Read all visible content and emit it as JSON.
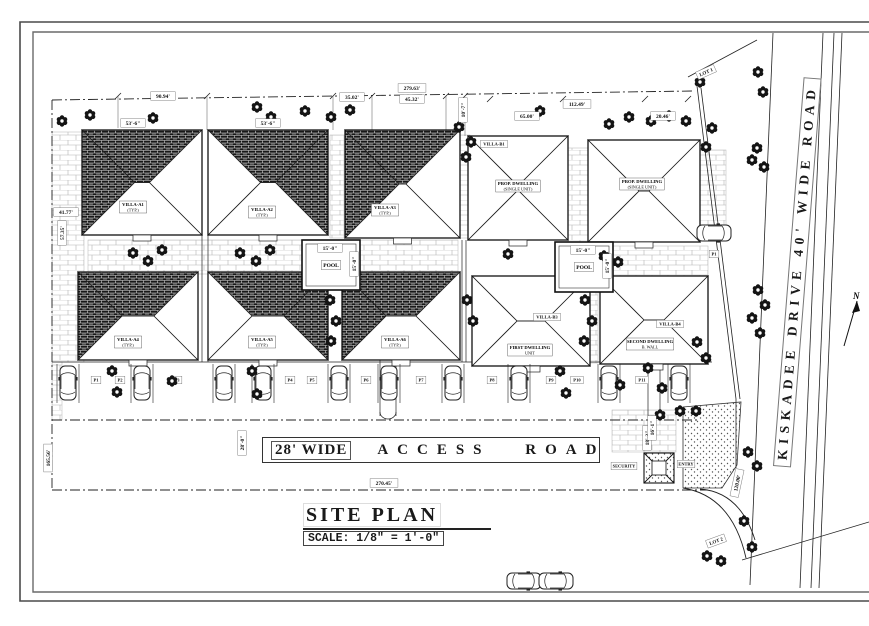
{
  "title_block": {
    "title": "SITE PLAN",
    "scale": "SCALE: 1/8\" = 1'-0\""
  },
  "roads": {
    "access_prefix": "28' WIDE",
    "access_name": "ACCESS ROAD",
    "main": "KISKADEE DRIVE 40' WIDE ROAD"
  },
  "north": {
    "label": "N",
    "x": 851,
    "y": 299
  },
  "lots": [
    {
      "text": "LOT 1",
      "x": 706,
      "y": 72,
      "rot": -24
    },
    {
      "text": "LOT 2",
      "x": 716,
      "y": 541,
      "rot": -20
    }
  ],
  "entrance": {
    "security_label": "SECURITY",
    "gate_label": "ENTRY",
    "booth": [
      644,
      453,
      30,
      30
    ],
    "security_pos": [
      624,
      466
    ],
    "gate_pos": [
      686,
      464
    ]
  },
  "pools": [
    {
      "label": "POOL",
      "dim": "15'-0\"",
      "x": 302,
      "y": 240,
      "w": 58,
      "h": 50
    },
    {
      "label": "POOL",
      "dim": "15'-0\"",
      "x": 555,
      "y": 242,
      "w": 58,
      "h": 50
    }
  ],
  "buildings": [
    {
      "id": "villa-a1",
      "label": "VILLA-A1",
      "sub": "(TYP.)",
      "x": 82,
      "y": 130,
      "w": 120,
      "h": 105,
      "hatch": true,
      "mirror": false,
      "lx": 133,
      "ly": 207
    },
    {
      "id": "villa-a2",
      "label": "VILLA-A2",
      "sub": "(TYP.)",
      "x": 208,
      "y": 130,
      "w": 120,
      "h": 105,
      "hatch": true,
      "mirror": true,
      "lx": 262,
      "ly": 212
    },
    {
      "id": "villa-a3",
      "label": "VILLA-A3",
      "sub": "(TYP.)",
      "x": 345,
      "y": 130,
      "w": 115,
      "h": 108,
      "hatch": true,
      "mirror": false,
      "lx": 385,
      "ly": 210
    },
    {
      "id": "villa-b1",
      "label": "PROP. DWELLING",
      "sub": "(SINGLE UNIT)",
      "tag": "VILLA-B1",
      "tx": 494,
      "ty": 144,
      "x": 468,
      "y": 136,
      "w": 100,
      "h": 104,
      "hatch": false,
      "lx": 518,
      "ly": 186
    },
    {
      "id": "villa-b2",
      "label": "PROP. DWELLING",
      "sub": "(SINGLE UNIT)",
      "x": 588,
      "y": 140,
      "w": 112,
      "h": 102,
      "hatch": false,
      "lx": 642,
      "ly": 184
    },
    {
      "id": "villa-a4",
      "label": "VILLA-A4",
      "sub": "(TYP.)",
      "x": 78,
      "y": 272,
      "w": 120,
      "h": 88,
      "hatch": true,
      "mirror": false,
      "lx": 128,
      "ly": 342
    },
    {
      "id": "villa-a5",
      "label": "VILLA-A5",
      "sub": "(TYP.)",
      "x": 208,
      "y": 272,
      "w": 120,
      "h": 88,
      "hatch": true,
      "mirror": true,
      "lx": 262,
      "ly": 342
    },
    {
      "id": "villa-a6",
      "label": "VILLA-A6",
      "sub": "(TYP.)",
      "x": 342,
      "y": 272,
      "w": 118,
      "h": 88,
      "hatch": true,
      "mirror": false,
      "lx": 395,
      "ly": 342
    },
    {
      "id": "villa-b3",
      "label": "FIRST DWELLING",
      "sub": "UNIT",
      "tag": "VILLA-B3",
      "tx": 547,
      "ty": 317,
      "x": 472,
      "y": 276,
      "w": 118,
      "h": 90,
      "hatch": false,
      "lx": 530,
      "ly": 350
    },
    {
      "id": "villa-b4",
      "label": "SECOND DWELLING",
      "sub": "B. WALL",
      "tag": "VILLA-B4",
      "tx": 670,
      "ty": 324,
      "x": 600,
      "y": 276,
      "w": 108,
      "h": 88,
      "hatch": false,
      "lx": 650,
      "ly": 344
    }
  ],
  "dimensions": [
    {
      "text": "90.94'",
      "x": 163,
      "y": 96,
      "rot": 0
    },
    {
      "text": "35.02'",
      "x": 352,
      "y": 97,
      "rot": 0
    },
    {
      "text": "279.63'",
      "x": 412,
      "y": 88,
      "rot": 0
    },
    {
      "text": "45.32'",
      "x": 412,
      "y": 99,
      "rot": 0
    },
    {
      "text": "65.00'",
      "x": 527,
      "y": 116,
      "rot": 0
    },
    {
      "text": "112.49'",
      "x": 577,
      "y": 104,
      "rot": 0
    },
    {
      "text": "20.46'",
      "x": 663,
      "y": 116,
      "rot": 0
    },
    {
      "text": "10'-7\"",
      "x": 463,
      "y": 110,
      "rot": -90
    },
    {
      "text": "41.77'",
      "x": 66,
      "y": 212,
      "rot": 0
    },
    {
      "text": "57.35'",
      "x": 62,
      "y": 233,
      "rot": -90
    },
    {
      "text": "165.56'",
      "x": 48,
      "y": 458,
      "rot": -90
    },
    {
      "text": "28'-0\"",
      "x": 242,
      "y": 443,
      "rot": -90
    },
    {
      "text": "18'-3\"",
      "x": 647,
      "y": 438,
      "rot": -90
    },
    {
      "text": "16'-1\"",
      "x": 652,
      "y": 428,
      "rot": -90
    },
    {
      "text": "270.45'",
      "x": 384,
      "y": 483,
      "rot": 0
    },
    {
      "text": "120.00'",
      "x": 737,
      "y": 483,
      "rot": -78
    },
    {
      "text": "15'-0\"",
      "x": 330,
      "y": 248,
      "rot": 0
    },
    {
      "text": "15'-0\"",
      "x": 583,
      "y": 250,
      "rot": 0
    },
    {
      "text": "15'-0\"",
      "x": 354,
      "y": 264,
      "rot": -90
    },
    {
      "text": "15'-0\"",
      "x": 607,
      "y": 266,
      "rot": -90
    },
    {
      "text": "53'-6\"",
      "x": 133,
      "y": 123,
      "rot": 0
    },
    {
      "text": "53'-6\"",
      "x": 268,
      "y": 123,
      "rot": 0
    }
  ],
  "parking": {
    "car_y": 383,
    "car_xs": [
      68,
      142,
      224,
      263,
      339,
      389,
      453,
      519,
      609,
      679
    ],
    "bay_labels": [
      "P1",
      "P2",
      "P3",
      "P4",
      "P5",
      "P6",
      "P7",
      "P8",
      "P9",
      "P10",
      "P11"
    ],
    "bay_label_pos": [
      [
        96,
        380
      ],
      [
        120,
        380
      ],
      [
        177,
        380
      ],
      [
        290,
        380
      ],
      [
        312,
        380
      ],
      [
        366,
        380
      ],
      [
        421,
        380
      ],
      [
        492,
        380
      ],
      [
        551,
        380
      ],
      [
        577,
        380
      ],
      [
        642,
        380
      ]
    ]
  },
  "extra_cars": [
    {
      "x": 714,
      "y": 233,
      "r": 90,
      "tag": "P1",
      "tagx": 714,
      "tagy": 254
    },
    {
      "x": 524,
      "y": 581,
      "r": 90
    },
    {
      "x": 556,
      "y": 581,
      "r": 90
    }
  ],
  "trees": [
    [
      62,
      121
    ],
    [
      90,
      115
    ],
    [
      153,
      118
    ],
    [
      257,
      107
    ],
    [
      271,
      117
    ],
    [
      305,
      111
    ],
    [
      331,
      117
    ],
    [
      350,
      110
    ],
    [
      459,
      127
    ],
    [
      471,
      142
    ],
    [
      466,
      157
    ],
    [
      540,
      111
    ],
    [
      609,
      124
    ],
    [
      629,
      117
    ],
    [
      651,
      121
    ],
    [
      669,
      116
    ],
    [
      686,
      121
    ],
    [
      700,
      82
    ],
    [
      712,
      128
    ],
    [
      706,
      147
    ],
    [
      758,
      72
    ],
    [
      763,
      92
    ],
    [
      757,
      148
    ],
    [
      764,
      167
    ],
    [
      752,
      160
    ],
    [
      758,
      290
    ],
    [
      765,
      305
    ],
    [
      752,
      318
    ],
    [
      760,
      333
    ],
    [
      748,
      452
    ],
    [
      757,
      466
    ],
    [
      744,
      521
    ],
    [
      752,
      547
    ],
    [
      707,
      556
    ],
    [
      721,
      561
    ],
    [
      133,
      253
    ],
    [
      148,
      261
    ],
    [
      162,
      250
    ],
    [
      240,
      253
    ],
    [
      256,
      261
    ],
    [
      270,
      250
    ],
    [
      330,
      300
    ],
    [
      336,
      321
    ],
    [
      331,
      341
    ],
    [
      467,
      300
    ],
    [
      473,
      321
    ],
    [
      585,
      300
    ],
    [
      592,
      321
    ],
    [
      584,
      341
    ],
    [
      604,
      256
    ],
    [
      618,
      262
    ],
    [
      508,
      254
    ],
    [
      112,
      371
    ],
    [
      117,
      392
    ],
    [
      172,
      381
    ],
    [
      252,
      371
    ],
    [
      257,
      394
    ],
    [
      560,
      371
    ],
    [
      566,
      393
    ],
    [
      620,
      385
    ],
    [
      697,
      342
    ],
    [
      706,
      358
    ],
    [
      648,
      368
    ],
    [
      662,
      388
    ],
    [
      680,
      411
    ],
    [
      660,
      415
    ],
    [
      696,
      411
    ]
  ],
  "paver_zones": [
    [
      52,
      132,
      32,
      230
    ],
    [
      88,
      240,
      370,
      34
    ],
    [
      330,
      135,
      14,
      103
    ],
    [
      460,
      135,
      10,
      103
    ],
    [
      568,
      148,
      30,
      215
    ],
    [
      600,
      246,
      108,
      30
    ],
    [
      700,
      150,
      26,
      78
    ],
    [
      612,
      410,
      64,
      42
    ],
    [
      52,
      362,
      10,
      58
    ]
  ],
  "scene": {
    "frame_outer": [
      20,
      22,
      869,
      601
    ],
    "frame_inner": [
      33,
      32,
      869,
      592
    ],
    "boundary_dashed": [
      [
        52,
        100,
        692,
        91
      ],
      [
        52,
        100,
        52,
        490
      ],
      [
        52,
        490,
        708,
        490
      ],
      [
        52,
        420,
        700,
        420
      ]
    ],
    "solid_lines": [
      [
        697,
        86,
        736,
        399
      ],
      [
        701,
        88,
        740,
        399
      ],
      [
        736,
        399,
        736,
        468
      ],
      [
        750,
        585,
        773,
        33
      ],
      [
        800,
        588,
        823,
        33
      ],
      [
        811,
        588,
        834,
        33
      ],
      [
        819,
        588,
        842,
        33
      ],
      [
        688,
        77,
        757,
        40
      ],
      [
        742,
        560,
        869,
        522
      ],
      [
        52,
        362,
        712,
        362
      ]
    ],
    "walkways": [
      [
        202,
        235,
        202,
        362
      ],
      [
        208,
        235,
        208,
        362
      ],
      [
        380,
        292,
        380,
        416
      ],
      [
        396,
        292,
        396,
        416
      ],
      [
        462,
        240,
        462,
        362
      ],
      [
        466,
        240,
        466,
        362
      ],
      [
        648,
        370,
        648,
        418
      ],
      [
        660,
        370,
        660,
        418
      ]
    ],
    "ticks": [
      [
        118,
        96
      ],
      [
        207,
        96
      ],
      [
        333,
        96
      ],
      [
        372,
        96
      ],
      [
        446,
        96
      ],
      [
        465,
        96
      ],
      [
        490,
        99
      ],
      [
        563,
        99
      ],
      [
        645,
        99
      ],
      [
        688,
        99
      ]
    ],
    "ext_lines": [
      [
        118,
        96,
        118,
        128
      ],
      [
        207,
        96,
        207,
        130
      ],
      [
        333,
        96,
        333,
        130
      ],
      [
        372,
        96,
        372,
        130
      ],
      [
        446,
        96,
        446,
        130
      ],
      [
        465,
        99,
        465,
        136
      ]
    ],
    "stipple_poly": "683,407 741,402 737,465 722,488 683,488",
    "curves": [
      "M700,489 Q740,492 755,540",
      "M683,488 Q732,496 746,558"
    ]
  }
}
